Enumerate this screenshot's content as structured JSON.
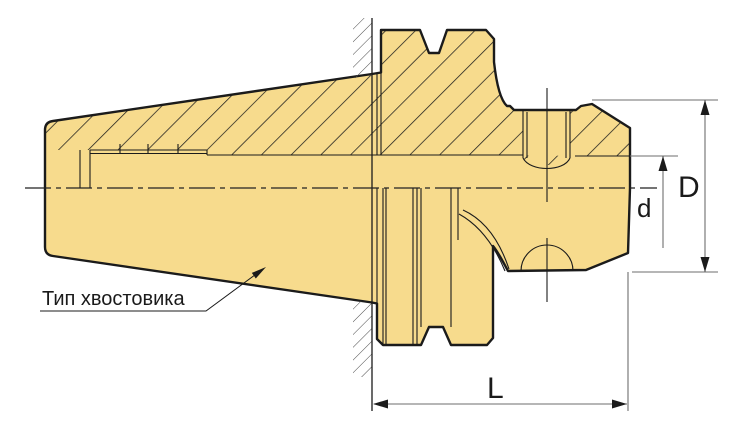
{
  "drawing": {
    "note": {
      "shank_type_label": "Тип хвостовика"
    },
    "dimensions": {
      "outer_diameter": "D",
      "inner_diameter": "d",
      "length": "L"
    }
  },
  "colors": {
    "body_fill": "#F7DB8D",
    "outline": "#1B1B1B",
    "dimension_line": "#6E6E6E",
    "hatch": "#1B1B1B",
    "wall_hatch": "#4A4A4A",
    "background": "#FFFFFF"
  }
}
